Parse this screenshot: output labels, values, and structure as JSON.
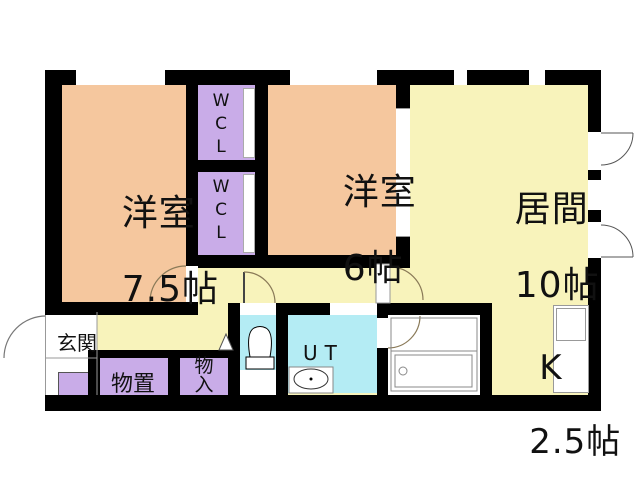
{
  "plan_title": "2LDK apartment floor plan",
  "colors": {
    "wall": "#000000",
    "bedroom_peach": "#F5C79E",
    "living_yellow": "#F8F3BB",
    "storage_purple": "#C9ACE8",
    "water_cyan": "#B4ECF4",
    "floor_white": "#FFFFFF"
  },
  "rooms": {
    "bedroom1": {
      "name": "洋室",
      "size": "7.5帖"
    },
    "bedroom2": {
      "name": "洋室",
      "size": "6帖"
    },
    "living": {
      "name": "居間",
      "size": "10帖"
    },
    "kitchen": {
      "name": "K",
      "size": "2.5帖"
    },
    "entrance": {
      "name": "玄関"
    },
    "storage": {
      "name": "物置"
    },
    "closet": {
      "chars": [
        "物",
        "入"
      ]
    },
    "wcl1": {
      "chars": [
        "W",
        "C",
        "L"
      ]
    },
    "wcl2": {
      "chars": [
        "W",
        "C",
        "L"
      ]
    },
    "utility": {
      "name": "UT"
    }
  }
}
